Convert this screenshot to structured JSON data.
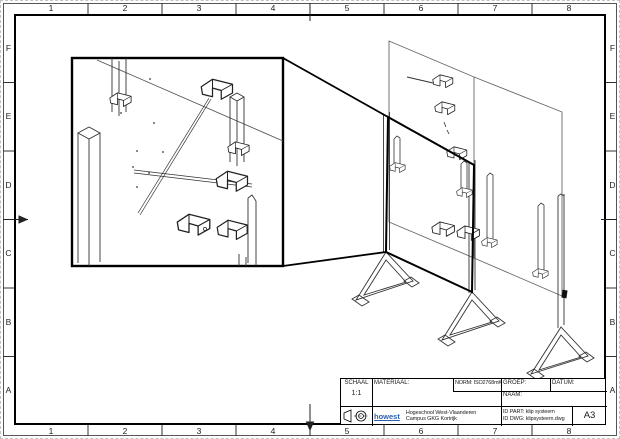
{
  "sheet": {
    "border": {
      "column_labels": [
        "1",
        "2",
        "3",
        "4",
        "5",
        "6",
        "7",
        "8"
      ],
      "row_labels": [
        "F",
        "E",
        "D",
        "C",
        "B",
        "A"
      ]
    },
    "title_block": {
      "schaal_label": "SCHAAL",
      "schaal_value": "1:1",
      "materiaal_label": "MATERIAAL:",
      "norm_label": "NORM: ISO2768mK",
      "groep_label": "GROEP:",
      "datum_label": "DATUM:",
      "naam_label": "NAAM:",
      "logo_text": "howest",
      "org_line1": "Hogeschool West-Vlaanderen",
      "org_line2": "Campus GKG Kortrijk",
      "id_part": "ID PART: klip systeem",
      "id_dwg": "ID DWG: klipsysteem.dwg",
      "format_label": "A3"
    },
    "icons": {
      "projection_symbol": "first-angle-projection"
    },
    "colors": {
      "line": "#1a1a1a",
      "panel_line": "#666666",
      "logo_blue": "#2b5fad"
    }
  }
}
